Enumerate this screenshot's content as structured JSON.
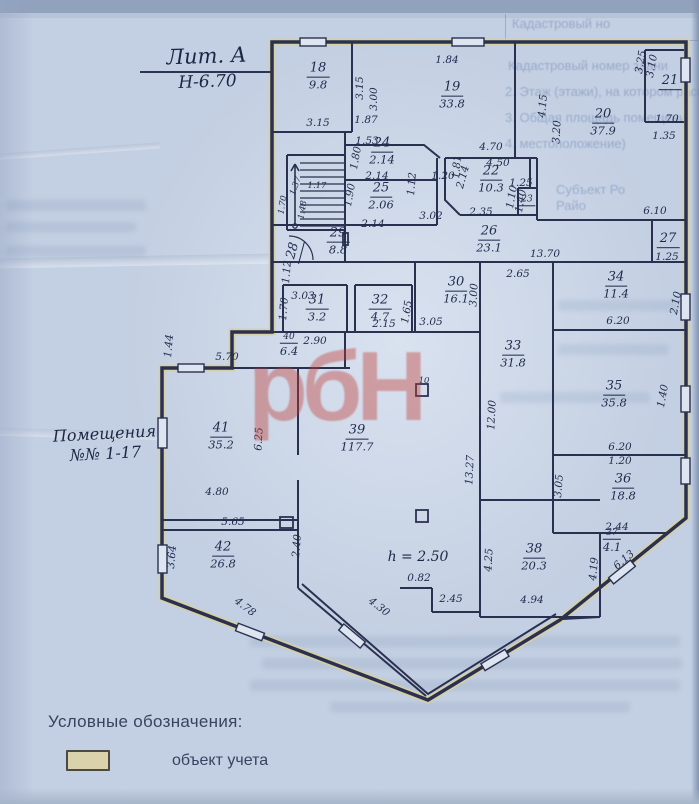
{
  "title_block": {
    "litera": "Лит. А",
    "height_mark": "Н-6.70"
  },
  "annotations": {
    "premises_note_line1": "Помещения",
    "premises_note_line2": "№№ 1-17",
    "ceiling_height": "h = 2.50"
  },
  "legend": {
    "title": "Условные обозначения:",
    "items": [
      {
        "swatch_color": "#d9d2ab",
        "label": "объект учета"
      }
    ]
  },
  "watermark": {
    "text": "рбН",
    "color": "#c23b35"
  },
  "ink_color": "#2a3150",
  "paper_color": "#c3cfe2",
  "highlight_color": "#d8cf9e",
  "plan": {
    "rooms": [
      {
        "number": "18",
        "area": "9.8",
        "x": 318,
        "y": 76
      },
      {
        "number": "19",
        "area": "33.8",
        "x": 452,
        "y": 95
      },
      {
        "number": "20",
        "area": "37.9",
        "x": 603,
        "y": 122
      },
      {
        "number": "21",
        "area": "",
        "x": 670,
        "y": 82
      },
      {
        "number": "22",
        "area": "10.3",
        "x": 491,
        "y": 179
      },
      {
        "number": "23",
        "area": "",
        "x": 527,
        "y": 201,
        "small": true
      },
      {
        "number": "24",
        "area": "2.14",
        "x": 382,
        "y": 151
      },
      {
        "number": "25",
        "area": "2.06",
        "x": 381,
        "y": 196
      },
      {
        "number": "26",
        "area": "23.1",
        "x": 489,
        "y": 239
      },
      {
        "number": "27",
        "area": "",
        "x": 668,
        "y": 240
      },
      {
        "number": "28",
        "area": "",
        "x": 294,
        "y": 251,
        "rot": -75
      },
      {
        "number": "29",
        "area": "8.8",
        "x": 338,
        "y": 241
      },
      {
        "number": "30",
        "area": "16.1",
        "x": 456,
        "y": 290
      },
      {
        "number": "31",
        "area": "3.2",
        "x": 317,
        "y": 308
      },
      {
        "number": "32",
        "area": "4.7",
        "x": 380,
        "y": 308
      },
      {
        "number": "33",
        "area": "31.8",
        "x": 513,
        "y": 354
      },
      {
        "number": "34",
        "area": "11.4",
        "x": 616,
        "y": 285
      },
      {
        "number": "35",
        "area": "35.8",
        "x": 614,
        "y": 394
      },
      {
        "number": "36",
        "area": "18.8",
        "x": 623,
        "y": 487
      },
      {
        "number": "37",
        "area": "4.1",
        "x": 612,
        "y": 541,
        "small": true
      },
      {
        "number": "38",
        "area": "20.3",
        "x": 534,
        "y": 557
      },
      {
        "number": "39",
        "area": "117.7",
        "x": 357,
        "y": 438
      },
      {
        "number": "40",
        "area": "6.4",
        "x": 289,
        "y": 345,
        "small": true
      },
      {
        "number": "41",
        "area": "35.2",
        "x": 221,
        "y": 436
      },
      {
        "number": "42",
        "area": "26.8",
        "x": 223,
        "y": 555
      }
    ],
    "dimensions": [
      {
        "text": "1.84",
        "x": 447,
        "y": 60,
        "rot": 0
      },
      {
        "text": "3.15",
        "x": 360,
        "y": 88,
        "rot": -90
      },
      {
        "text": "3.00",
        "x": 374,
        "y": 99,
        "rot": -90
      },
      {
        "text": "3.15",
        "x": 318,
        "y": 123,
        "rot": 0
      },
      {
        "text": "1.87",
        "x": 366,
        "y": 120,
        "rot": 0
      },
      {
        "text": "1.53",
        "x": 367,
        "y": 141,
        "rot": 0
      },
      {
        "text": "1.80",
        "x": 356,
        "y": 158,
        "rot": -80
      },
      {
        "text": "2.14",
        "x": 377,
        "y": 176,
        "rot": 0
      },
      {
        "text": "1.90",
        "x": 350,
        "y": 195,
        "rot": -80
      },
      {
        "text": "2.14",
        "x": 373,
        "y": 224,
        "rot": 0
      },
      {
        "text": "1.12",
        "x": 412,
        "y": 184,
        "rot": -85
      },
      {
        "text": "1.20",
        "x": 443,
        "y": 176,
        "rot": 0
      },
      {
        "text": "1.81",
        "x": 457,
        "y": 167,
        "rot": -85
      },
      {
        "text": "2.14",
        "x": 463,
        "y": 177,
        "rot": -75
      },
      {
        "text": "4.70",
        "x": 491,
        "y": 147,
        "rot": 0
      },
      {
        "text": "4.50",
        "x": 498,
        "y": 163,
        "rot": 0
      },
      {
        "text": "1.25",
        "x": 521,
        "y": 183,
        "rot": 0
      },
      {
        "text": "1.10",
        "x": 512,
        "y": 197,
        "rot": -80
      },
      {
        "text": "1.40",
        "x": 521,
        "y": 201,
        "rot": -80
      },
      {
        "text": "2.35",
        "x": 481,
        "y": 212,
        "rot": 0
      },
      {
        "text": "3.02",
        "x": 431,
        "y": 216,
        "rot": 0
      },
      {
        "text": "4.15",
        "x": 543,
        "y": 106,
        "rot": -85
      },
      {
        "text": "3.20",
        "x": 557,
        "y": 132,
        "rot": -87
      },
      {
        "text": "3.25",
        "x": 641,
        "y": 62,
        "rot": -80
      },
      {
        "text": "3.10",
        "x": 652,
        "y": 66,
        "rot": -80
      },
      {
        "text": "1.70",
        "x": 667,
        "y": 119,
        "rot": 0
      },
      {
        "text": "1.35",
        "x": 664,
        "y": 136,
        "rot": 0
      },
      {
        "text": "6.10",
        "x": 655,
        "y": 211,
        "rot": 0
      },
      {
        "text": "1.25",
        "x": 667,
        "y": 257,
        "rot": 0
      },
      {
        "text": "13.70",
        "x": 545,
        "y": 254,
        "rot": 0
      },
      {
        "text": "2.65",
        "x": 518,
        "y": 274,
        "rot": 0
      },
      {
        "text": "3.03",
        "x": 303,
        "y": 296,
        "rot": 0
      },
      {
        "text": "1.70",
        "x": 284,
        "y": 309,
        "rot": -85
      },
      {
        "text": "2.90",
        "x": 315,
        "y": 341,
        "rot": 0
      },
      {
        "text": "2.15",
        "x": 384,
        "y": 324,
        "rot": 0
      },
      {
        "text": "1.65",
        "x": 407,
        "y": 312,
        "rot": -80
      },
      {
        "text": "3.05",
        "x": 431,
        "y": 322,
        "rot": 0
      },
      {
        "text": "3.00",
        "x": 474,
        "y": 295,
        "rot": -87
      },
      {
        "text": "6.20",
        "x": 618,
        "y": 321,
        "rot": 0
      },
      {
        "text": "2.10",
        "x": 676,
        "y": 303,
        "rot": -80
      },
      {
        "text": "12.00",
        "x": 492,
        "y": 415,
        "rot": -87
      },
      {
        "text": "13.27",
        "x": 470,
        "y": 470,
        "rot": -87
      },
      {
        "text": "6.20",
        "x": 620,
        "y": 447,
        "rot": 0
      },
      {
        "text": "1.20",
        "x": 620,
        "y": 461,
        "rot": 0
      },
      {
        "text": "1.40",
        "x": 663,
        "y": 396,
        "rot": -80
      },
      {
        "text": "3.05",
        "x": 559,
        "y": 486,
        "rot": -85
      },
      {
        "text": "2.44",
        "x": 617,
        "y": 527,
        "rot": 0
      },
      {
        "text": "6.13",
        "x": 624,
        "y": 560,
        "rot": -40
      },
      {
        "text": "4.19",
        "x": 594,
        "y": 569,
        "rot": -85
      },
      {
        "text": "4.25",
        "x": 489,
        "y": 560,
        "rot": -87
      },
      {
        "text": "4.94",
        "x": 532,
        "y": 600,
        "rot": 0
      },
      {
        "text": "2.45",
        "x": 451,
        "y": 599,
        "rot": 0
      },
      {
        "text": "0.82",
        "x": 419,
        "y": 578,
        "rot": 0
      },
      {
        "text": "4.30",
        "x": 379,
        "y": 607,
        "rot": 38
      },
      {
        "text": "2.40",
        "x": 297,
        "y": 546,
        "rot": -85
      },
      {
        "text": "5.65",
        "x": 233,
        "y": 522,
        "rot": 0
      },
      {
        "text": "4.80",
        "x": 217,
        "y": 492,
        "rot": 0
      },
      {
        "text": "6.25",
        "x": 259,
        "y": 439,
        "rot": -87
      },
      {
        "text": "5.70",
        "x": 227,
        "y": 357,
        "rot": 0
      },
      {
        "text": "1.44",
        "x": 169,
        "y": 346,
        "rot": -85
      },
      {
        "text": "3.64",
        "x": 172,
        "y": 557,
        "rot": -85
      },
      {
        "text": "4.78",
        "x": 245,
        "y": 607,
        "rot": 38
      },
      {
        "text": "1.37",
        "x": 296,
        "y": 186,
        "rot": -70,
        "tiny": true
      },
      {
        "text": "1.17",
        "x": 317,
        "y": 186,
        "rot": 0,
        "tiny": true
      },
      {
        "text": "1.48",
        "x": 303,
        "y": 210,
        "rot": -80,
        "tiny": true
      },
      {
        "text": "1.70",
        "x": 283,
        "y": 205,
        "rot": -80,
        "tiny": true
      },
      {
        "text": "1.12",
        "x": 287,
        "y": 272,
        "rot": -85
      },
      {
        "text": "10",
        "x": 424,
        "y": 381,
        "rot": 0,
        "tiny": true
      }
    ]
  },
  "bleedthrough": [
    {
      "text": "Кадастровый но",
      "x": 512,
      "y": 16
    },
    {
      "text": "Кадастровый номер здани",
      "x": 508,
      "y": 58
    },
    {
      "text": "2. Этаж (этажи), на котором расп",
      "x": 505,
      "y": 84
    },
    {
      "text": "3. Общая площадь помещени",
      "x": 505,
      "y": 110
    },
    {
      "text": "4. местоположение)",
      "x": 505,
      "y": 136
    },
    {
      "text": "Субъект Ро",
      "x": 556,
      "y": 182
    },
    {
      "text": "Райо",
      "x": 556,
      "y": 198
    }
  ]
}
